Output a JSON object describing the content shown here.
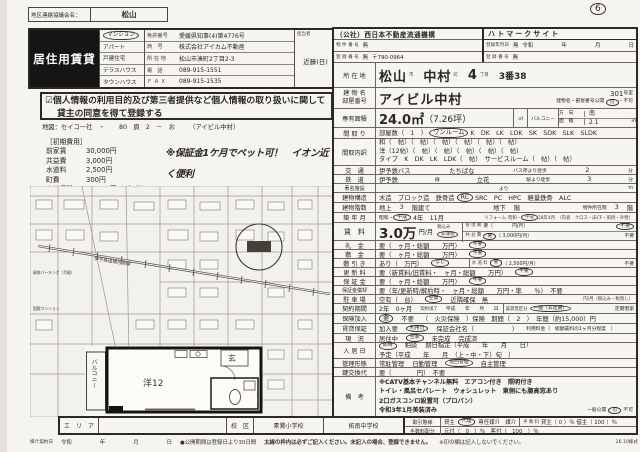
{
  "meta": {
    "district_label": "地区連絡協議会名：",
    "district_value": "松山",
    "page_mark": "6",
    "colors": {
      "paper": "#f6f4f0",
      "ink": "#2a2722",
      "doc_type_bg": "#161513"
    }
  },
  "agency": {
    "doc_type": "居住用賃貸",
    "types": [
      "マンション",
      "アパート",
      "戸建住宅",
      "テラスハウス",
      "タウンハウス"
    ],
    "selected_type": "マンション",
    "license_label": "免許番号",
    "license_value": "愛媛県知事(4)第4776号",
    "name_label": "商　号",
    "name_value": "株式会社アイカム不動産",
    "addr_label": "所 在 地",
    "addr_value": "松山市湊町2丁目2-3",
    "tel_label": "電　話",
    "tel_value": "089-915-1551",
    "fax_label": "Ｆ Ａ Ｘ",
    "fax_value": "089-915-1535",
    "staff_label": "担当者",
    "staff_value": "近藤(日)"
  },
  "privacy": {
    "check": "☑",
    "line1": "個人情報の利用目的及び第三者提供など個人情報の取り扱いに関して",
    "line2": "貸主の同意を得て登録する"
  },
  "mapref": {
    "label": "地図：セイコー社　・",
    "value": "80　頁　2　－　お",
    "note": "（アイビル中村）"
  },
  "costs": {
    "title": "［初期費用］",
    "items": [
      {
        "name": "前家賃",
        "value": "30,000円"
      },
      {
        "name": "共益費",
        "value": "3,000円"
      },
      {
        "name": "水道料",
        "value": "2,500円"
      },
      {
        "name": "町費",
        "value": "300円"
      },
      {
        "name": "火災保険",
        "value": "15,000円（2年分）"
      }
    ]
  },
  "slogans": {
    "s1": "※保証金1ケ月でペット可！　イオン近く便利",
    "s2": "※平成28年リフォーム済み　デザイナーズ！"
  },
  "map": {
    "railway": "伊予鉄道横河原線",
    "label1": "駅前パーキング（月極）",
    "label2": "国際マンション"
  },
  "plan": {
    "balcony": "バルコニー",
    "room": "洋12",
    "entrance": "玄"
  },
  "t": {
    "org_name": "（公社）西日本不動産流通機構",
    "org_no_label": "物 件 番 号",
    "org_no": "無",
    "org_reg_label": "登 録 番 号",
    "org_reg": "無",
    "org_postal": "〒790-0964",
    "hato_title": "ハトマークサイト",
    "hato_date_label": "登録年月日",
    "hato_date": "無",
    "hato_era": "令和",
    "hato_y": "年",
    "hato_m": "月",
    "hato_d": "日",
    "hato_reg_label": "登 録 番 号",
    "hato_reg": "無",
    "loc_label": "所 在 地",
    "loc_city": "松山",
    "loc_city_u": "市",
    "loc_town": "中村",
    "loc_town_u": "町",
    "loc_chome": "4",
    "loc_chome_u": "丁目",
    "loc_banchi": "3番38",
    "bldg_label1": "建 物 名",
    "bldg_label2": "部屋番号",
    "bldg_name": "アイビル中村",
    "bldg_room": "301",
    "bldg_room_u": "号室",
    "bldg_pub_label": "建物名・部屋番号公開",
    "bldg_pub_yes": "可",
    "bldg_pub_sep": "・",
    "bldg_pub_no": "不可",
    "area_label": "専有面積",
    "area_value": "24.0㎡",
    "area_tsubo": "（7.26坪）",
    "area_unit": "㎡",
    "bal_label": "バルコニー",
    "bal_dir_label": "方　向",
    "bal_dir": "南",
    "bal_area_label": "面　積",
    "bal_area": "2.1",
    "bal_unit": "㎡",
    "madori_label": "間 取 り",
    "madori_pre": "部屋数（　1　）",
    "madori_circ": "ワンルーム",
    "madori_post": "K　DK　LK　LDK　SK　SDK　SLK　SLDK",
    "mu_label": "間取内訳",
    "mu_l1": "和（　帖）（　帖）（　帖）（　帖）（　帖）（　帖）",
    "mu_l2": "洋（12帖）（　帖）（　帖）（　帖）（　帖）（　帖）",
    "mu_l3": "タイプ　K　DK　LK　LDK（　帖）　サービスルーム（　帖）（　帖）",
    "acc_label": "交　通",
    "acc_bus": "伊予鉄バス",
    "acc_stop": "たちばな",
    "acc_walk": "バス停より徒歩",
    "acc_min": "2",
    "acc_u": "分",
    "rail_label": "鉄　道",
    "rail_co": "伊予鉄",
    "rail_line_u": "線",
    "rail_st": "立花",
    "rail_walk": "駅より徒歩",
    "rail_min": "3",
    "rail_u": "分",
    "fac_label": "著名施設",
    "fac_more": "より",
    "fac_u": "m",
    "str_label": "建物構造",
    "str_pre": "木造　ブロック造　鉄骨造",
    "str_circ": "RC",
    "str_post": "SRC　PC　HPC　軽量鉄骨　ALC",
    "fl_label": "建物階数",
    "fl_a": "地上",
    "fl_av": "3",
    "fl_au": "階建て",
    "fl_b": "地下",
    "fl_bu": "階",
    "fl_c": "物件所在階",
    "fl_cv": "3",
    "fl_cu": "階",
    "built_label": "築 年 月",
    "built_e1": "昭和・",
    "built_e2": "平成",
    "built_v": "4年　11月",
    "reform_label": "リフォーム",
    "reform_e1": "昭和・",
    "reform_e2": "平成",
    "reform_v": "28年4月",
    "reform_note": "（内容　クロス・床CF・照明・外壁）",
    "rent_label": "賃　料",
    "rent_v": "3.0万",
    "rent_u": "円/月",
    "rent_tax1": "税込み",
    "rent_tax2": "非課税",
    "rent_m_label": "管 理 費",
    "rent_m_yes": "要（　　　　円/月）",
    "rent_m_no": "不要",
    "rent_k_label": "共 益 費",
    "rent_k_yes": "要",
    "rent_k_v": "（ 3,000円/月）",
    "rent_k_no": "不要",
    "rei_label": "礼　金",
    "rei_yes": "要（　ヶ月・総額　　万円）",
    "rei_no": "不要",
    "shiki_label": "敷　金",
    "shiki_yes": "要（　ヶ月・総額　　万円）",
    "shiki_no": "不要",
    "hiki_label": "敷 引 き",
    "hiki_yes": "あり（　万円）",
    "hiki_no": "なし",
    "water_label": "水 道 料",
    "water_yes": "要",
    "water_v": "（ 2,500円/月）",
    "water_no": "不要",
    "kou_label": "更 新 料",
    "kou_yes": "要（新賃料/旧賃料・　ヶ月・総額　　万円）",
    "kou_no": "不要",
    "hosho_label": "保 証 金",
    "hosho_yes": "要（　ヶ月・総額　　万円）",
    "hosho_no": "不要",
    "shok_label": "保証金償却",
    "shok_text": "要（年/更新時/解約時・　ヶ月・総額　　万円・率　　％）　不要",
    "park_label": "駐 車 場",
    "park_a": "空有（　台）",
    "park_b": "空無",
    "park_c": "近隣確保　無",
    "park_d": "円/月（税込み・税無し）",
    "ctr_label": "契約期間",
    "ctr_a": "2年　0ヶ月",
    "ctr_b": "契約満了",
    "ctr_c": "平成　　年　　月　　日",
    "ctr_d_label": "賃貸借区分",
    "ctr_d1": "一般（非定期）",
    "ctr_d2": "定期借家",
    "ins_label": "保険加入",
    "ins_yes": "要",
    "ins_no": "不要",
    "ins_detail": "（　火災保険　）保険　期間（　2　）　年間（約15,000）円",
    "gua_label": "賃貸保証",
    "gua_a": "加入要",
    "gua_b": "利用可",
    "gua_c": "保証会社名（　　　　　　）",
    "gua_d": "利用料金（　総額賃料の1ヶ月分程度　）",
    "gen_label": "現　況",
    "gen_a": "居住中",
    "gen_b": "空家",
    "gen_c": "未完成",
    "gen_d": "完成済",
    "nyu_label": "入 居 日",
    "nyu_a": "即時",
    "nyu_b": "相談",
    "nyu_c": "期日指定（平成　　年　　月　　日）",
    "nyu_l2": "予定（平成　　年　　月　（上・中・下）旬　）",
    "kan_label": "管理形態",
    "kan_a": "常駐管理",
    "kan_b": "日勤管理",
    "kan_c": "巡回管理",
    "kan_d": "自主管理",
    "kagi_label": "鍵交換代",
    "kagi_text": "要（　　　　円）　不要",
    "biko_label": "備　考",
    "biko_l1": "※CATV基本チャンネル無料　エアコン付き　照明付き",
    "biko_l2": "トイレ・風呂セパレート　ウォシュレット　東側にも腰高窓あり",
    "biko_l3": "2口ガスコンロ設置可（プロパン）",
    "biko_l4": "令和3年1月美装済み",
    "biko_pub_label": "一般公開",
    "biko_pub_yes": "可",
    "biko_pub_no": "不可",
    "deal_label": "取引態様",
    "deal_a": "貸主",
    "deal_b": "代理",
    "deal_c": "専任媒介　媒介",
    "fee_label": "手 数 料",
    "fee_text": "貸主（ 0 ）％ 借主（ 100 ）％",
    "dist_label": "手数料配分",
    "dist_text": "元付（　0　）％　客付（　100　）％"
  },
  "bottom": {
    "area_label": "エ　リ　ア",
    "school_label": "校　区",
    "elem": "素鵞小学校",
    "jhs": "拓南中学校",
    "contract_label": "媒介契約日",
    "era": "令和",
    "y": "年",
    "m": "月",
    "d": "日",
    "note1": "●公開期間は登録日より30日間",
    "note2": "太線の枠内は必ずご記入ください。未記入の場合、登録できません。",
    "note3": "※印の欄は記入しないでください。",
    "code": "26.10様式"
  }
}
